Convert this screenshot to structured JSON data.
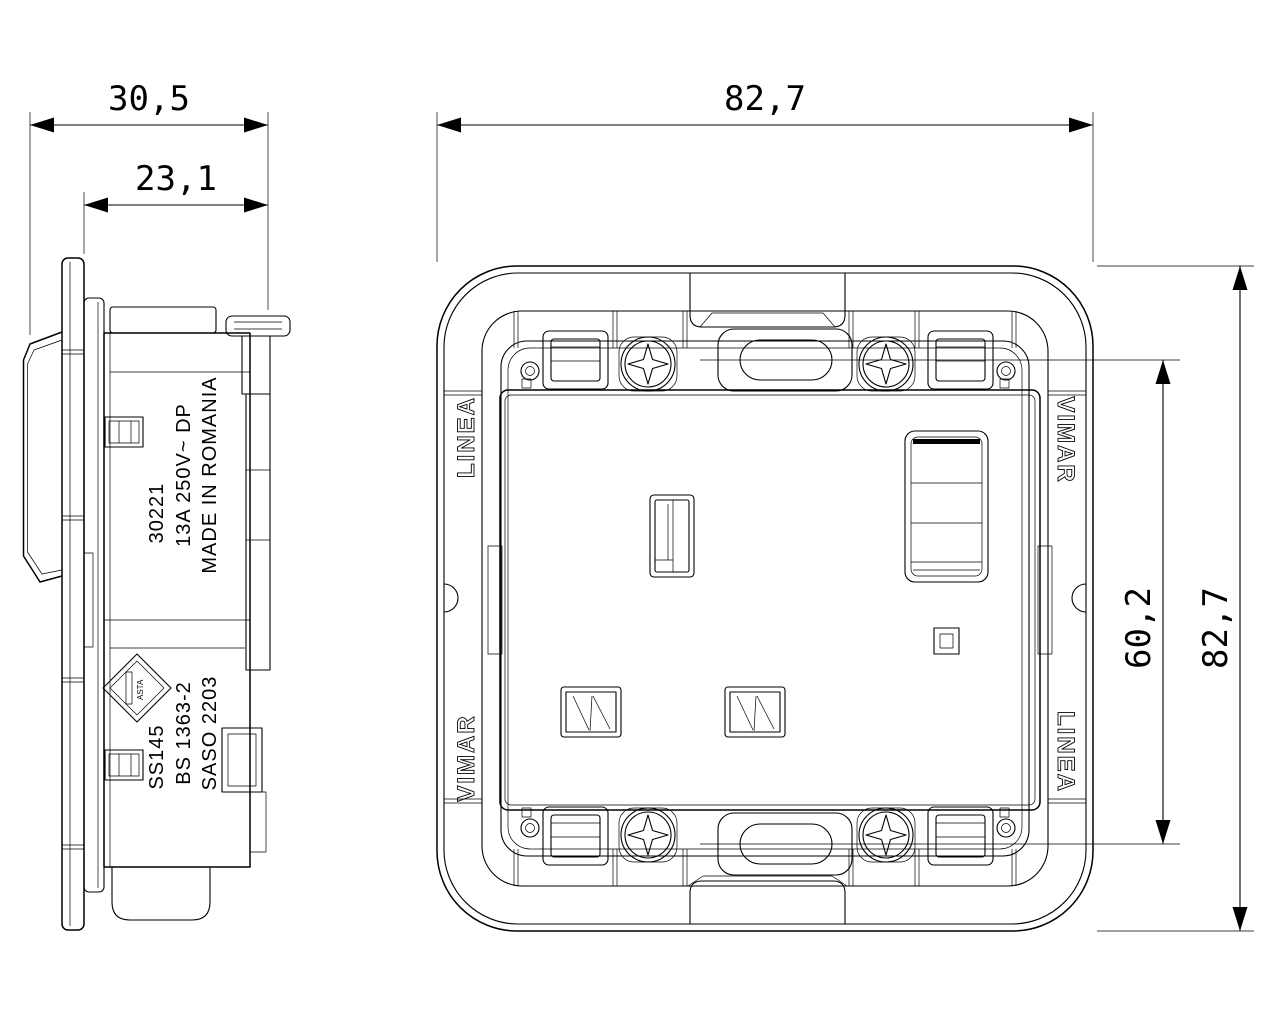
{
  "title": "Vimar UK socket technical drawing",
  "colors": {
    "line": "#000000",
    "background": "#ffffff"
  },
  "dims": {
    "side_total_depth": "30,5",
    "side_embed_depth": "23,1",
    "front_width": "82,7",
    "front_height": "82,7",
    "screw_centres": "60,2"
  },
  "side_markings": {
    "part_number": "30221",
    "rating": "13A 250V~ DP",
    "origin": "MADE IN ROMANIA",
    "model": "SS145",
    "standard": "BS 1363-2",
    "saso": "SASO 2203",
    "asta": "ASTA"
  },
  "front_labels": {
    "left_top": "LINEA",
    "left_bottom": "VIMAR",
    "right_top": "VIMAR",
    "right_bottom": "LINEA"
  }
}
